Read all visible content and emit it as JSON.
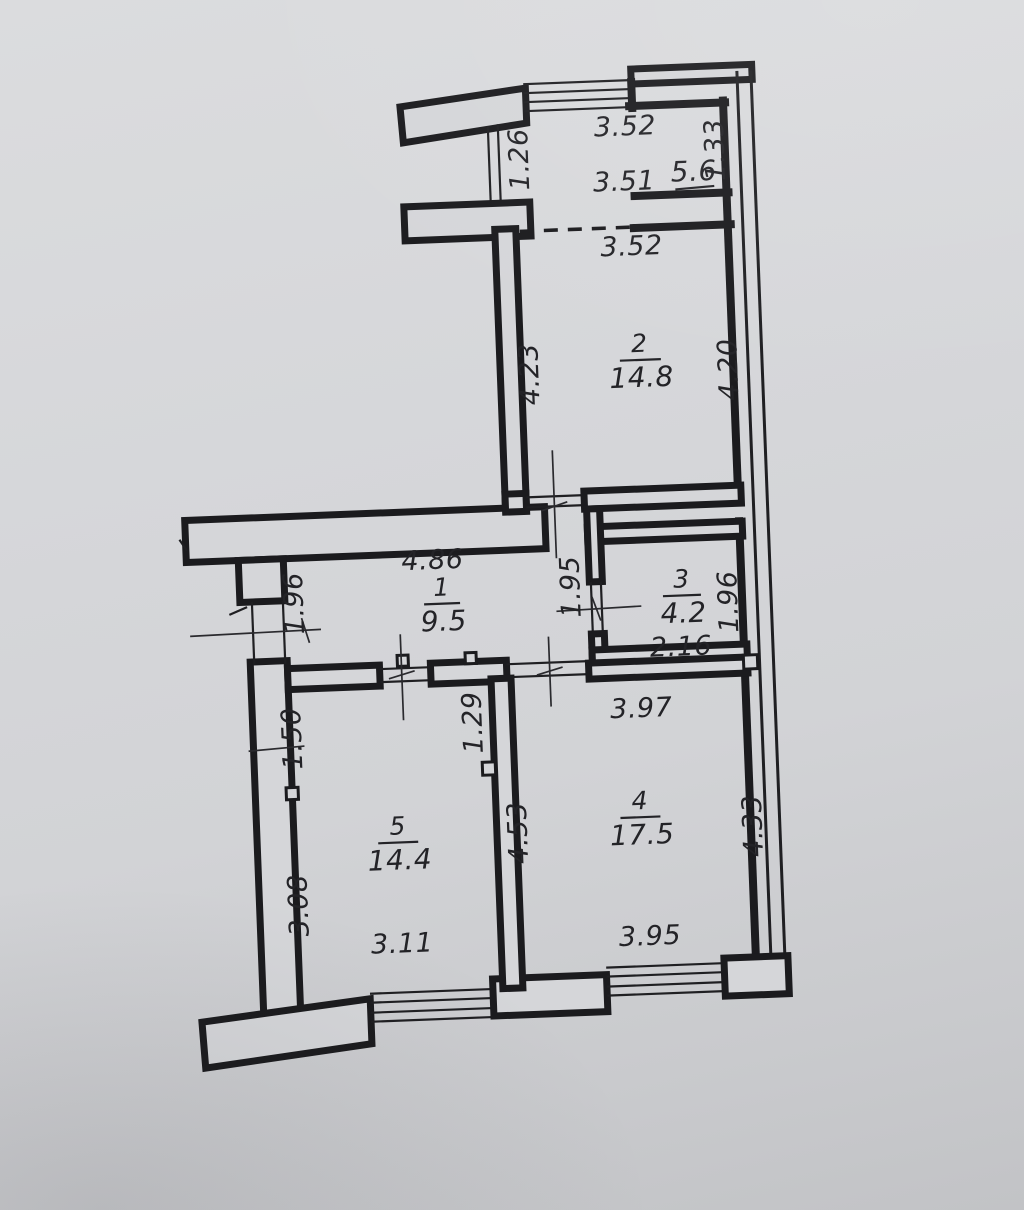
{
  "palette": {
    "paper": "#d5d6d9",
    "ink": "#1b1b1e",
    "text": "#232327"
  },
  "rooms": [
    {
      "number": "1",
      "area": "9.5"
    },
    {
      "number": "2",
      "area": "14.8"
    },
    {
      "number": "3",
      "area": "4.2"
    },
    {
      "number": "4",
      "area": "17.5"
    },
    {
      "number": "5",
      "area": "14.4"
    }
  ],
  "balcony_area": "5.6",
  "dims": {
    "top_window": "3.52",
    "balcony_partition": "1.26",
    "balcony_niche": "1.33",
    "balcony_length": "3.51",
    "room2_opening": "3.52",
    "room2_left": "4.23",
    "room2_right": "4.20",
    "room1_length": "4.86",
    "room1_left": "1.96",
    "room3_door_side": "1.95",
    "room3_right": "1.96",
    "room3_width": "2.16",
    "room4_top": "3.97",
    "room5_left_upper": "1.50",
    "room5_partition_upper": "1.29",
    "room4_partition": "4.53",
    "room4_right": "4.33",
    "room5_left_lower": "3.08",
    "room5_bottom": "3.11",
    "room4_bottom": "3.95"
  }
}
